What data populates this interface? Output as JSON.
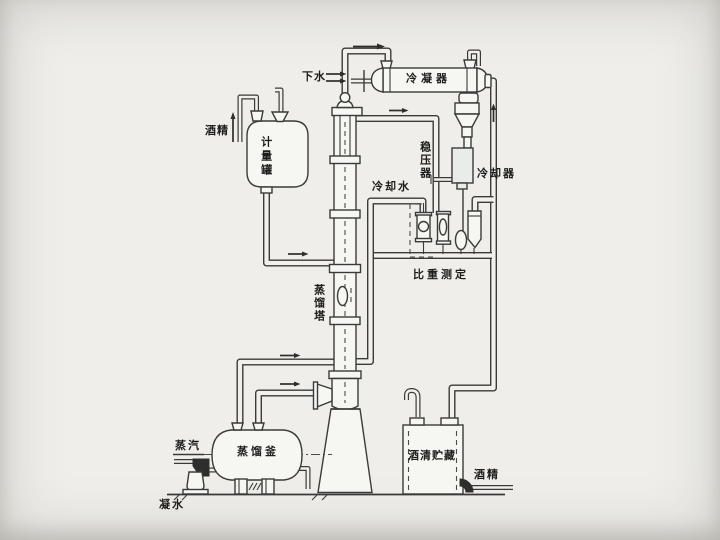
{
  "diagram": {
    "labels": {
      "drain_water": "下水",
      "condenser": "冷凝器",
      "alcohol_feed": "酒精",
      "measuring_tank": "计量罐",
      "stabilizer": "稳压器",
      "cooling_water": "冷却水",
      "cooler": "冷却器",
      "gravity_measure": "比重测定",
      "column": "蒸馏塔",
      "steam": "蒸汽",
      "kettle": "蒸馏釜",
      "storage": "酒清贮藏",
      "alcohol_out": "酒精",
      "condensate": "凝水"
    },
    "colors": {
      "line": "#3a3a38",
      "background": "#efeeea",
      "vessel_fill": "#f6f7f3",
      "dark_fitting": "#2e2e2c"
    }
  }
}
